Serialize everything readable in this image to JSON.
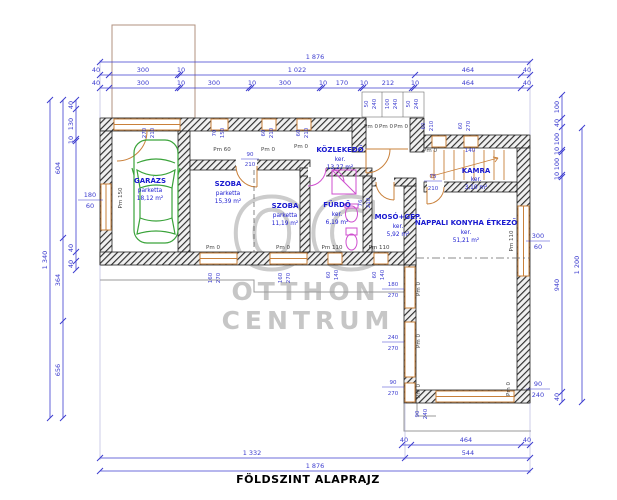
{
  "title": "FÖLDSZINT ALAPRAJZ",
  "watermark": {
    "logo": "OC",
    "line1": "OTTHON",
    "line2": "CENTRUM"
  },
  "colors": {
    "dimension": "#3c3ccf",
    "room_label": "#1a1ad0",
    "wall": "#2f2f2f",
    "window_door": "#c9803a",
    "car": "#3aa33a",
    "sanitary": "#cf4fcf",
    "watermark": "#c8c8c8",
    "terrace": "#9a9a9a",
    "title": "#000000"
  },
  "rooms": [
    {
      "name": "GARÁZS",
      "finish": "parketta",
      "area": "18,12 m²"
    },
    {
      "name": "SZOBA",
      "finish": "parketta",
      "area": "15,39 m²"
    },
    {
      "name": "SZOBA",
      "finish": "parketta",
      "area": "11,19 m²"
    },
    {
      "name": "FÜRDŐ",
      "finish": "ker.",
      "area": "6,19 m²"
    },
    {
      "name": "MOSÓ+GÉP.",
      "finish": "ker.",
      "area": "5,92 m²"
    },
    {
      "name": "KÖZLEKEDŐ",
      "finish": "ker.",
      "area": "13,27 m²"
    },
    {
      "name": "KAMRA",
      "finish": "ker.",
      "area": "3,10 m²"
    },
    {
      "name": "NAPPALI KONYHA ÉTKEZŐ",
      "finish": "ker.",
      "area": "51,21 m²"
    }
  ],
  "dims": {
    "top_total": "1 876",
    "top2": [
      "40",
      "300",
      "10",
      "1 022",
      "464",
      "40"
    ],
    "top3": [
      "40",
      "300",
      "10",
      "300",
      "10",
      "300",
      "10",
      "170",
      "10",
      "212",
      "10",
      "464",
      "40"
    ],
    "porch": [
      "50",
      "240",
      "100",
      "240",
      "50",
      "240"
    ],
    "left_total": "1 340",
    "left_mid": [
      "604",
      "364",
      "656"
    ],
    "left_inner": [
      "40",
      "130",
      "10",
      "40",
      "40"
    ],
    "garage_window": {
      "w": "180",
      "h": "60"
    },
    "right_inner": [
      "100",
      "40",
      "100",
      "10",
      "100",
      "10",
      "940",
      "40"
    ],
    "right_total": "1 200",
    "right_window": {
      "w": "300",
      "h": "60"
    },
    "right_door": {
      "w": "90",
      "h": "240"
    },
    "bottom1": [
      "40",
      "464",
      "40"
    ],
    "bottom2": [
      "1 332",
      "544"
    ],
    "bottom_total": "1 876"
  },
  "openings": [
    {
      "w": "270",
      "h": "210"
    },
    {
      "w": "70",
      "h": "150"
    },
    {
      "w": "60",
      "h": "210"
    },
    {
      "w": "60",
      "h": "210"
    },
    {
      "w": "60",
      "h": "210"
    },
    {
      "w": "60",
      "h": "270"
    },
    {
      "w": "90",
      "h": "210"
    },
    {
      "w": "75",
      "h": "210"
    },
    {
      "w": "140",
      "h": ""
    },
    {
      "w": "76",
      "h": "210"
    },
    {
      "w": "160",
      "h": "270"
    },
    {
      "w": "160",
      "h": "270"
    },
    {
      "w": "60",
      "h": "140"
    },
    {
      "w": "60",
      "h": "140"
    },
    {
      "w": "180",
      "h": "270"
    },
    {
      "w": "240",
      "h": "270"
    },
    {
      "w": "90",
      "h": "270"
    },
    {
      "w": "90",
      "h": "240"
    }
  ],
  "pm": [
    "Pm 150",
    "Pm 60",
    "Pm 0",
    "Pm 0",
    "Pm 0",
    "Pm 0",
    "Pm 0",
    "Pm 0",
    "Pm 0",
    "Pm 0",
    "Pm 110",
    "Pm 110",
    "Pm 0",
    "Pm 0",
    "Pm 0",
    "Pm 110",
    "Pm 0"
  ]
}
